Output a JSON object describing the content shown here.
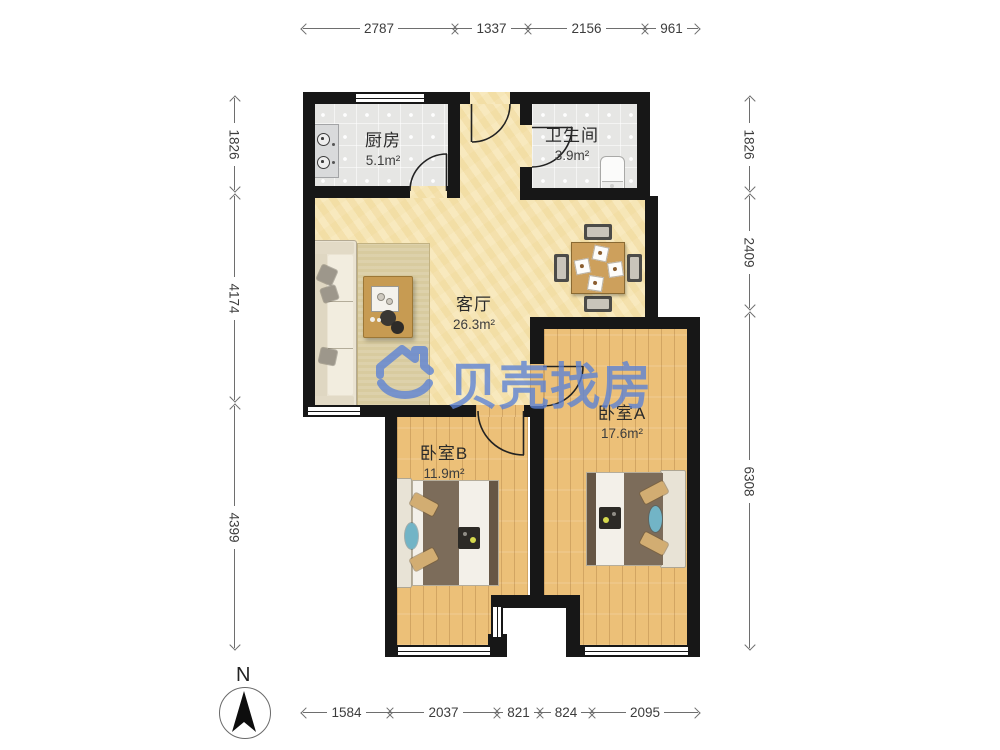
{
  "watermark": {
    "text": "贝壳找房",
    "color": "#5b82d6",
    "logo": "beike-house-smile-logo"
  },
  "compass": {
    "label": "N"
  },
  "rooms": [
    {
      "id": "kitchen",
      "name": "厨房",
      "area": "5.1m²"
    },
    {
      "id": "bathroom",
      "name": "卫生间",
      "area": "3.9m²"
    },
    {
      "id": "living",
      "name": "客厅",
      "area": "26.3m²"
    },
    {
      "id": "bedroomA",
      "name": "卧室A",
      "area": "17.6m²"
    },
    {
      "id": "bedroomB",
      "name": "卧室B",
      "area": "11.9m²"
    }
  ],
  "dimensions": {
    "top": [
      "2787",
      "1337",
      "2156",
      "961"
    ],
    "bottom": [
      "1584",
      "2037",
      "821",
      "824",
      "2095"
    ],
    "left": [
      "1826",
      "4174",
      "4399"
    ],
    "right": [
      "1826",
      "2409",
      "6308"
    ]
  },
  "colors": {
    "wall": "#171717",
    "living_floor": "#f5e2ab",
    "bedroom_floor": "#ecc078",
    "tile_floor": "#e6e6e4",
    "watermark_blue": "#5b82d6"
  }
}
